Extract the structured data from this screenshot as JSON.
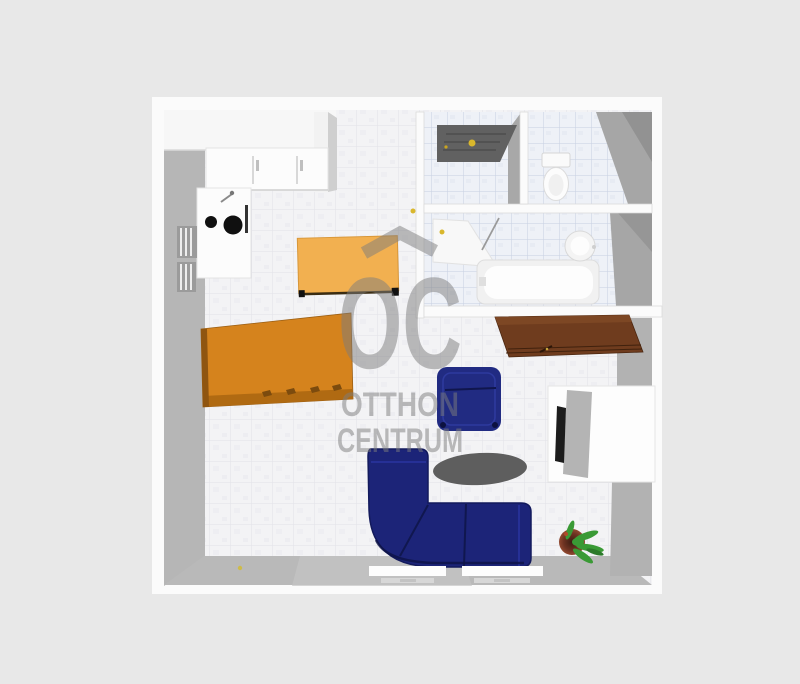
{
  "scene": {
    "title": "3D apartment floor plan render",
    "background_color": "#e8e8e8",
    "watermark": {
      "logo_text": "OC",
      "brand_line1": "OTTHON",
      "brand_line2": "CENTRUM",
      "color": "#7d7d7d"
    },
    "palette": {
      "wall_white": "#fbfbfb",
      "wall_face_gray": "#b6b6b6",
      "room_shadow_gray": "#a4a4a4",
      "deep_shadow_gray": "#939393",
      "floor_living": "#f3f3f5",
      "floor_bath": "#edf0f7",
      "front_door_gray": "#616161",
      "table_light_orange": "#f2b050",
      "bed_orange": "#d5831d",
      "sofa_navy": "#1c2478",
      "armchair_navy": "#212b82",
      "rug_gray": "#5e5e5e",
      "sideboard_brown": "#6f3c1e",
      "tv_black": "#1c1c1c",
      "desk_panel_gray": "#b4b4b4",
      "handle_yellow": "#d9b72c",
      "plant_green": "#3a9a35",
      "pot_brown": "#7a3b2a",
      "burner_black": "#101010",
      "fixture_white": "#fcfcfc",
      "radiator_gray": "#9b9b9b"
    },
    "items": [
      "kitchen-counter",
      "kitchen-sink",
      "stove-burners",
      "radiator",
      "front-door",
      "hall-door-handle",
      "toilet",
      "bathroom-door",
      "bathtub",
      "washbasin",
      "dining-table",
      "orange-bed-table",
      "armchair",
      "corner-sofa",
      "rug",
      "sideboard",
      "tv-desk",
      "potted-plant",
      "window-sill",
      "balcony-door-handle"
    ]
  }
}
